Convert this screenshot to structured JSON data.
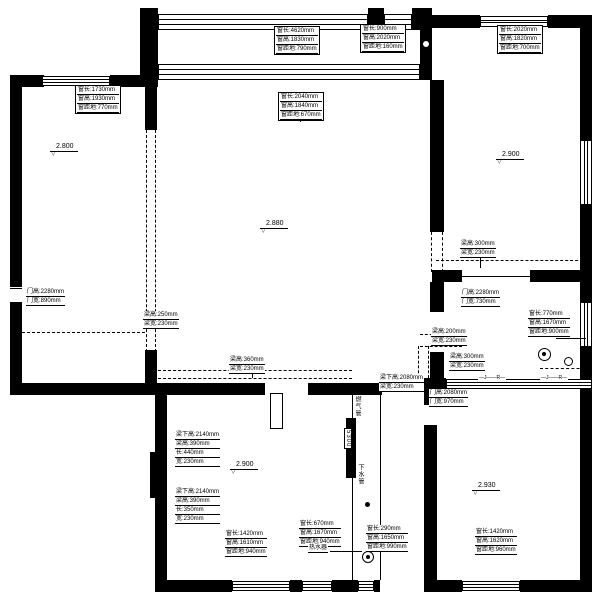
{
  "drawing": {
    "levels": [
      {
        "symbol": "▽",
        "value": "2.800"
      },
      {
        "symbol": "▽",
        "value": "2.880"
      },
      {
        "symbol": "▽",
        "value": "2.900"
      },
      {
        "symbol": "▽",
        "value": "2.900"
      },
      {
        "symbol": "▽",
        "value": "2.930"
      }
    ],
    "annotations": [
      {
        "kind": "window",
        "lines": [
          "窗长:4620mm",
          "窗高:1830mm",
          "窗距地:790mm"
        ]
      },
      {
        "kind": "window",
        "lines": [
          "窗长:900mm",
          "窗高:2020mm",
          "窗距地:160mm"
        ]
      },
      {
        "kind": "window",
        "lines": [
          "窗长:2020mm",
          "窗高:1820mm",
          "窗距地:700mm"
        ]
      },
      {
        "kind": "window",
        "lines": [
          "窗长:1730mm",
          "窗高:1930mm",
          "窗距地:770mm"
        ]
      },
      {
        "kind": "window",
        "lines": [
          "窗长:2040mm",
          "窗高:1840mm",
          "窗距地:670mm"
        ]
      },
      {
        "kind": "beam",
        "lines": [
          "梁高:300mm",
          "梁宽:230mm"
        ]
      },
      {
        "kind": "door",
        "lines": [
          "门高:2280mm",
          "门宽:730mm"
        ]
      },
      {
        "kind": "door",
        "lines": [
          "门高:2280mm",
          "门宽:890mm"
        ]
      },
      {
        "kind": "beam",
        "lines": [
          "梁高:250mm",
          "梁宽:230mm"
        ]
      },
      {
        "kind": "beam",
        "lines": [
          "梁高:360mm",
          "梁宽:230mm"
        ]
      },
      {
        "kind": "beam",
        "lines": [
          "梁高:200mm",
          "梁宽:230mm"
        ]
      },
      {
        "kind": "beam",
        "lines": [
          "梁高:300mm",
          "梁宽:230mm"
        ]
      },
      {
        "kind": "beam",
        "lines": [
          "梁下高:2080mm",
          "梁宽:230mm"
        ]
      },
      {
        "kind": "door",
        "lines": [
          "门高:2080mm",
          "门宽:970mm"
        ]
      },
      {
        "kind": "beam-column",
        "lines": [
          "梁下高:2140mm",
          "梁高:390mm",
          "长:440mm",
          "宽:230mm"
        ]
      },
      {
        "kind": "beam-column",
        "lines": [
          "梁下高:2140mm",
          "梁高:390mm",
          "长:350mm",
          "宽:230mm"
        ]
      },
      {
        "kind": "window",
        "lines": [
          "窗长:1420mm",
          "窗高:1610mm",
          "窗距地:940mm"
        ]
      },
      {
        "kind": "window",
        "lines": [
          "窗长:670mm",
          "窗高:1670mm",
          "窗距地:940mm"
        ]
      },
      {
        "kind": "window",
        "lines": [
          "窗长:290mm",
          "窗高:1650mm",
          "窗距地:990mm"
        ]
      },
      {
        "kind": "window",
        "lines": [
          "窗长:1420mm",
          "窗高:1620mm",
          "窗距地:960mm"
        ]
      },
      {
        "kind": "window",
        "lines": [
          "窗长:770mm",
          "窗高:1670mm",
          "窗距地:900mm"
        ]
      }
    ],
    "labels": {
      "water_heater": "热水器",
      "shaft_pipe_top": "燃气管",
      "shaft_pipe_bottom": "下水管",
      "shaft_dim": "5300",
      "radiator_tag_1": "—J——R—",
      "radiator_tag_2": "—J——R—"
    }
  }
}
